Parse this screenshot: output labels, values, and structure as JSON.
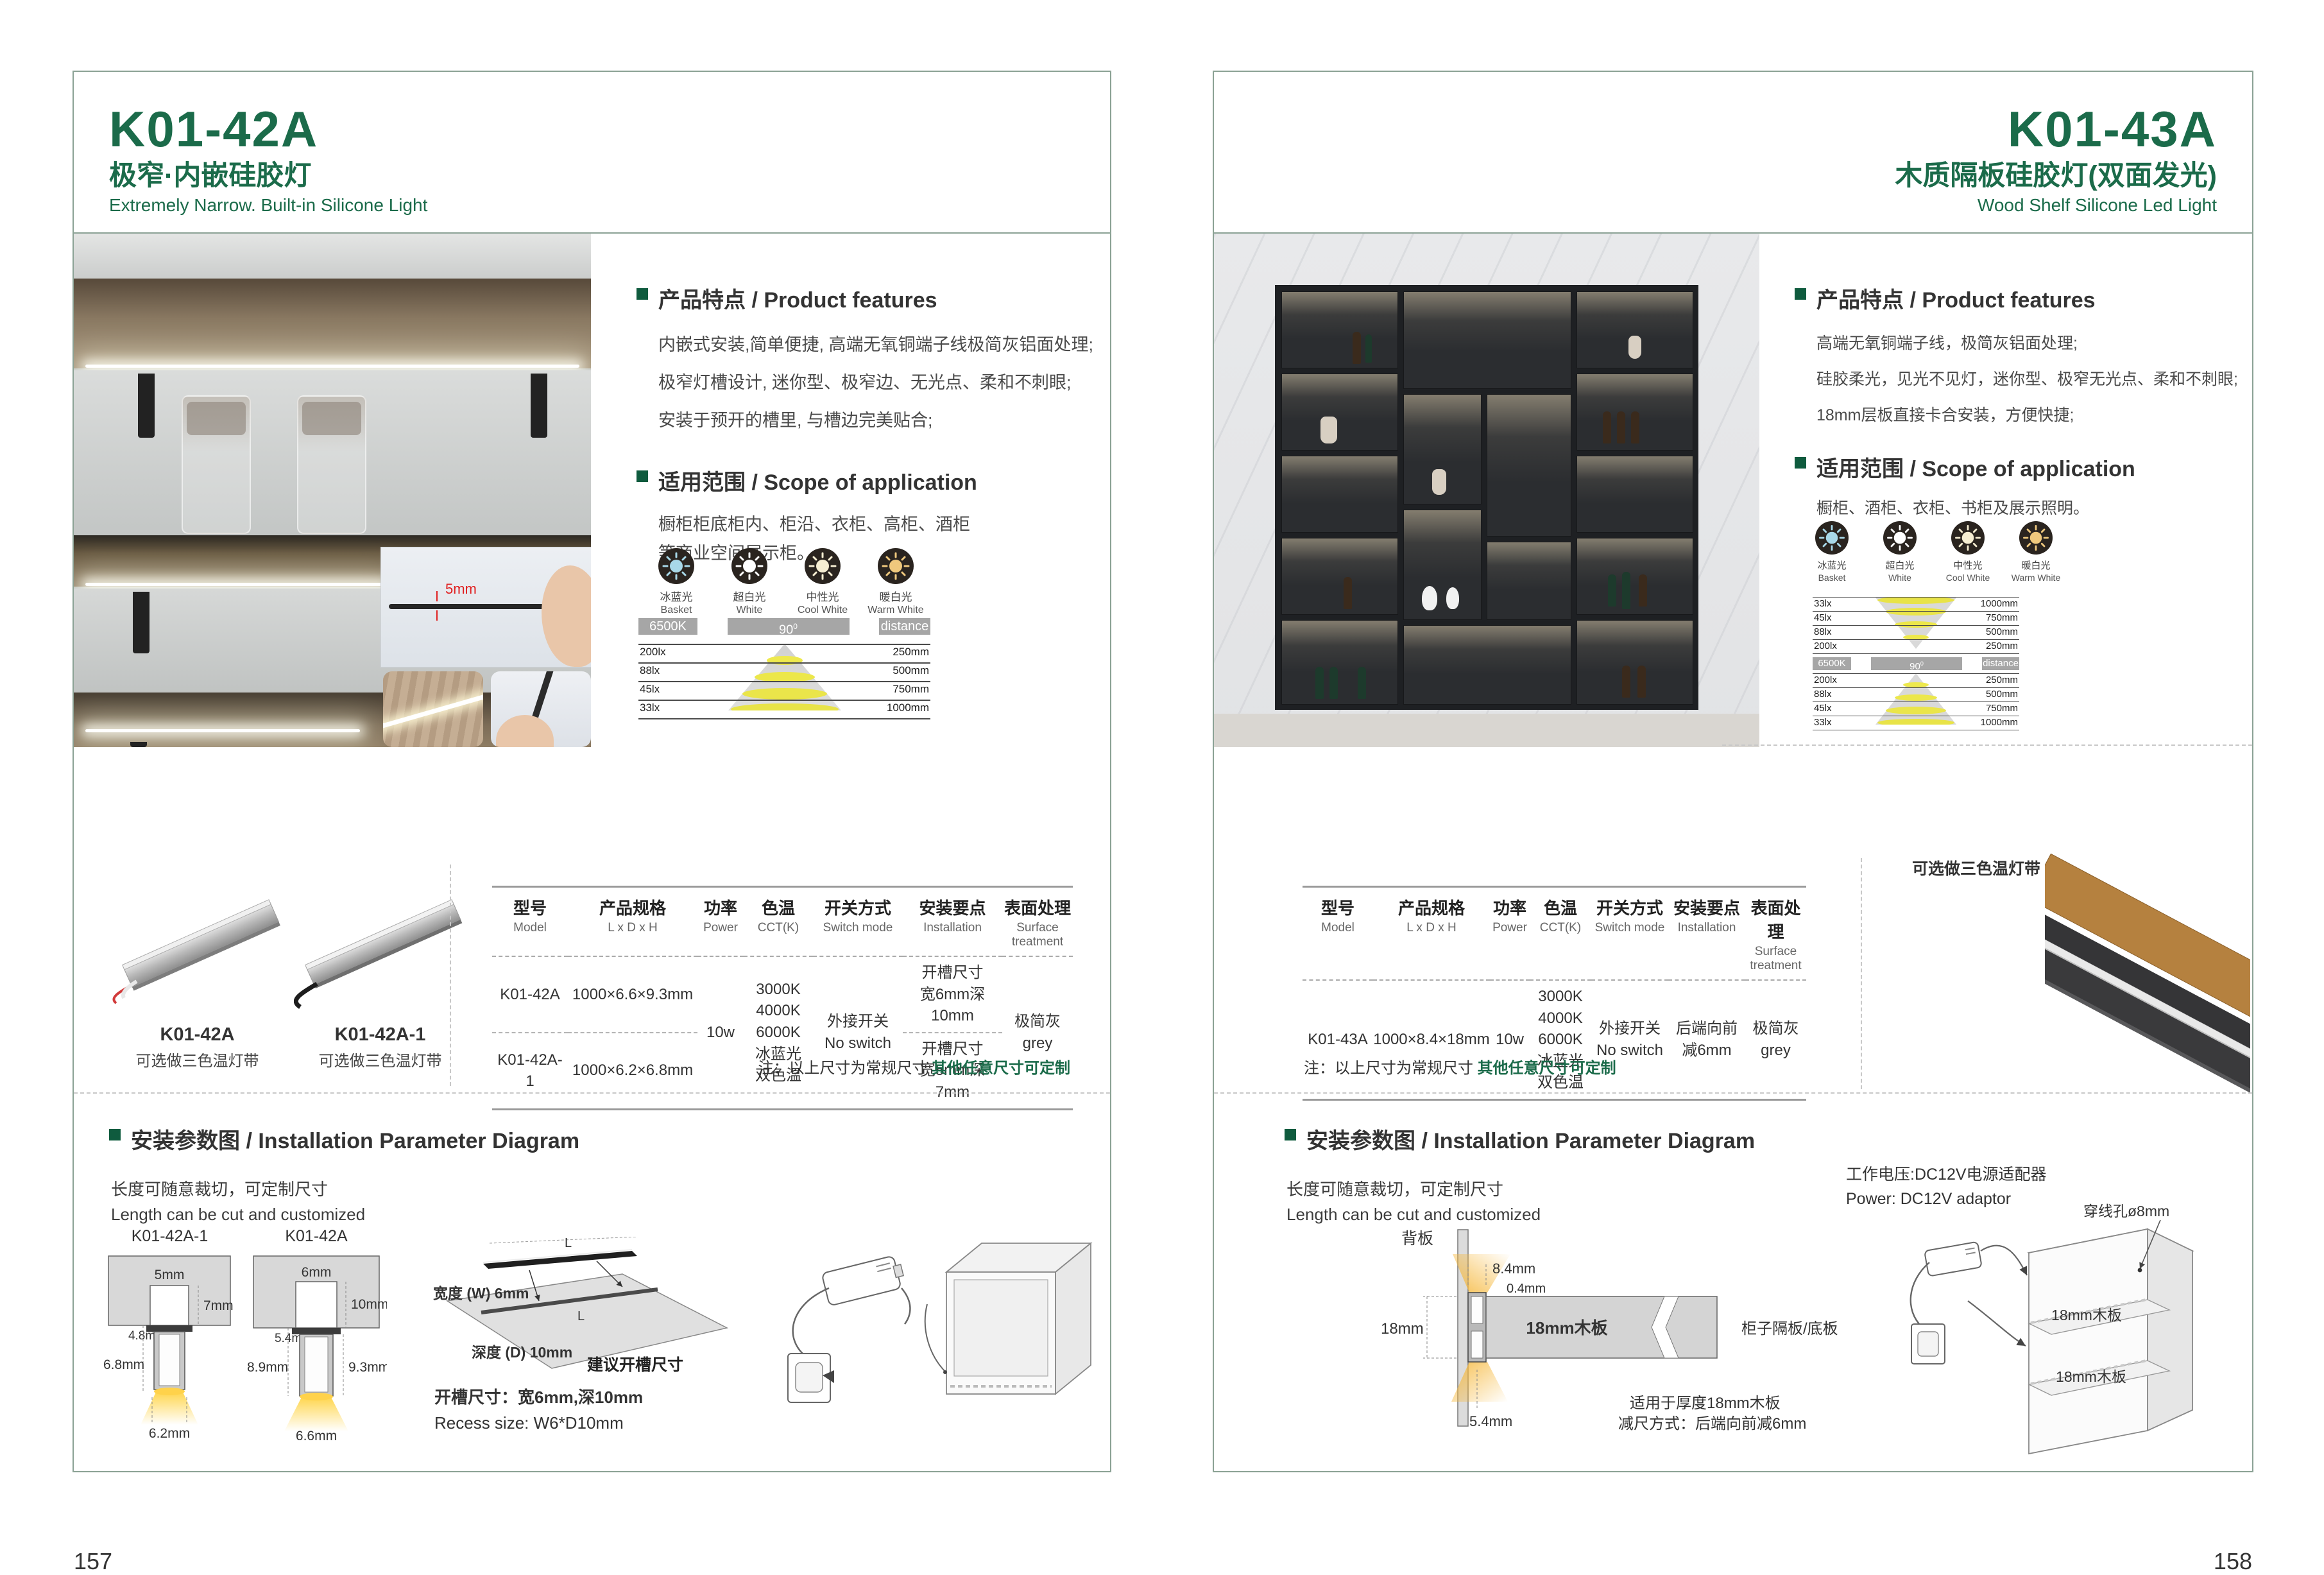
{
  "colors": {
    "accent_green": "#1b6b4a",
    "bullet_green": "#0f5b3e",
    "border_green": "#8ba295",
    "chip_gray": "#a6a6a6"
  },
  "cct_options": [
    {
      "cn": "冰蓝光",
      "en": "Basket",
      "color": "#a8d8e8"
    },
    {
      "cn": "超白光",
      "en": "White",
      "color": "#ffffff"
    },
    {
      "cn": "中性光",
      "en": "Cool White",
      "color": "#f6eed2"
    },
    {
      "cn": "暖白光",
      "en": "Warm White",
      "color": "#efc87d"
    }
  ],
  "photometry": {
    "cct": "6500K",
    "angle": "90",
    "angle_sup": "0",
    "distance": "distance",
    "rows": [
      {
        "lx": "200lx",
        "mm": "250mm"
      },
      {
        "lx": "88lx",
        "mm": "500mm"
      },
      {
        "lx": "45lx",
        "mm": "750mm"
      },
      {
        "lx": "33lx",
        "mm": "1000mm"
      }
    ]
  },
  "spec_headers": [
    {
      "cn": "型号",
      "en": "Model"
    },
    {
      "cn": "产品规格",
      "en": "L x D x H"
    },
    {
      "cn": "功率",
      "en": "Power"
    },
    {
      "cn": "色温",
      "en": "CCT(K)"
    },
    {
      "cn": "开关方式",
      "en": "Switch mode"
    },
    {
      "cn": "安装要点",
      "en": "Installation"
    },
    {
      "cn": "表面处理",
      "en": "Surface treatment"
    }
  ],
  "note": {
    "prefix": "注：以上尺寸为常规尺寸 ",
    "highlight": "其他任意尺寸可定制"
  },
  "install_heading": "安装参数图 / Installation Parameter Diagram",
  "cut_cn": "长度可随意裁切，可定制尺寸",
  "cut_en": "Length can be cut and customized",
  "left": {
    "page_number": "157",
    "model": "K01-42A",
    "title_cn": "极窄·内嵌硅胶灯",
    "title_en": "Extremely Narrow. Built-in Silicone Light",
    "features_heading": "产品特点 / Product features",
    "features": [
      "内嵌式安装,简单便捷, 高端无氧铜端子线极简灰铝面处理;",
      "极窄灯槽设计, 迷你型、极窄边、无光点、柔和不刺眼;",
      "安装于预开的槽里, 与槽边完美贴合;"
    ],
    "scope_heading": "适用范围 / Scope of application",
    "scope": [
      "橱柜柜底柜内、柜沿、衣柜、高柜、酒柜",
      "等商业空间展示柜。"
    ],
    "inset_dim": "5mm",
    "products": [
      {
        "name": "K01-42A",
        "sub": "可选做三色温灯带"
      },
      {
        "name": "K01-42A-1",
        "sub": "可选做三色温灯带"
      }
    ],
    "spec": {
      "rows": [
        {
          "model": "K01-42A",
          "size": "1000×6.6×9.3mm"
        },
        {
          "model": "K01-42A-1",
          "size": "1000×6.2×6.8mm"
        }
      ],
      "power": "10w",
      "cct": [
        "3000K",
        "4000K",
        "6000K",
        "冰蓝光",
        "双色温"
      ],
      "switch_cn": "外接开关",
      "switch_en": "No switch",
      "install": [
        {
          "l1": "开槽尺寸",
          "l2": "宽6mm深10mm"
        },
        {
          "l1": "开槽尺寸",
          "l2": "宽5mm深7mm"
        }
      ],
      "surface_cn": "极简灰",
      "surface_en": "grey"
    },
    "diag1": {
      "label": "K01-42A-1",
      "w_top": "5mm",
      "d_right": "7mm",
      "w_inner": "4.8mm",
      "h_left": "6.8mm",
      "w_bottom": "6.2mm"
    },
    "diag2": {
      "label": "K01-42A",
      "w_top": "6mm",
      "d_right": "10mm",
      "w_inner": "5.4mm",
      "h_left": "8.9mm",
      "h_right": "9.3mm",
      "w_bottom": "6.6mm"
    },
    "groove": {
      "l_top": "L",
      "l_in": "L",
      "width": "宽度 (W) 6mm",
      "depth": "深度 (D) 10mm",
      "suggest": "建议开槽尺寸",
      "note_cn": "开槽尺寸：宽6mm,深10mm",
      "note_en": "Recess size: W6*D10mm"
    }
  },
  "right": {
    "page_number": "158",
    "model": "K01-43A",
    "title_cn": "木质隔板硅胶灯(双面发光)",
    "title_en": "Wood Shelf Silicone Led Light",
    "features_heading": "产品特点 / Product features",
    "features": [
      "高端无氧铜端子线，极简灰铝面处理;",
      "硅胶柔光，见光不见灯，迷你型、极窄无光点、柔和不刺眼;",
      "18mm层板直接卡合安装，方便快捷;"
    ],
    "scope_heading": "适用范围 / Scope of application",
    "scope": [
      "橱柜、酒柜、衣柜、书柜及展示照明。"
    ],
    "product_label": "可选做三色温灯带",
    "spec": {
      "model": "K01-43A",
      "size": "1000×8.4×18mm",
      "power": "10w",
      "cct": [
        "3000K",
        "4000K",
        "6000K",
        "冰蓝光",
        "双色温"
      ],
      "switch_cn": "外接开关",
      "switch_en": "No switch",
      "install_l1": "后端向前",
      "install_l2": "减6mm",
      "surface_cn": "极简灰",
      "surface_en": "grey"
    },
    "power_cn": "工作电压:DC12V电源适配器",
    "power_en": "Power: DC12V adaptor",
    "cross": {
      "back": "背板",
      "d1": "8.4mm",
      "d2": "0.4mm",
      "d3": "18mm",
      "board": "18mm木板",
      "right_label": "柜子隔板/底板",
      "d4": "5.4mm",
      "note1": "适用于厚度18mm木板",
      "note2": "减尺方式：后端向前减6mm"
    },
    "cabinet": {
      "hole": "穿线孔ø8mm",
      "shelf1": "18mm木板",
      "shelf2": "18mm木板"
    }
  }
}
